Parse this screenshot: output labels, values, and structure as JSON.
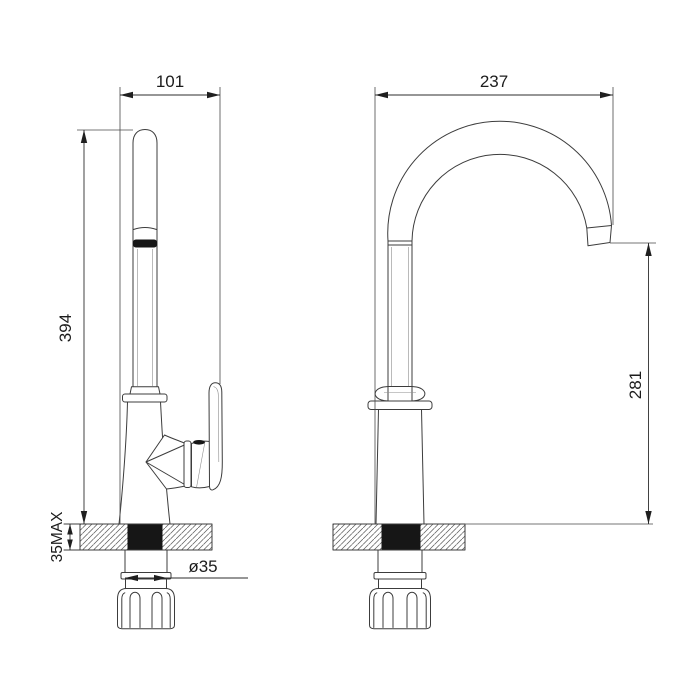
{
  "drawing": {
    "subject": "kitchen-faucet-two-view-technical-drawing",
    "background": "#ffffff",
    "line_color": "#3c3c3c",
    "text_color": "#1c1c1c",
    "hole_color": "#161616"
  },
  "dimensions": {
    "front_overall_width": "101",
    "spout_reach": "237",
    "overall_height": "394",
    "spout_outlet_height": "281",
    "max_deck_thickness": "35MAX",
    "mounting_shank_diameter": "ø35"
  }
}
